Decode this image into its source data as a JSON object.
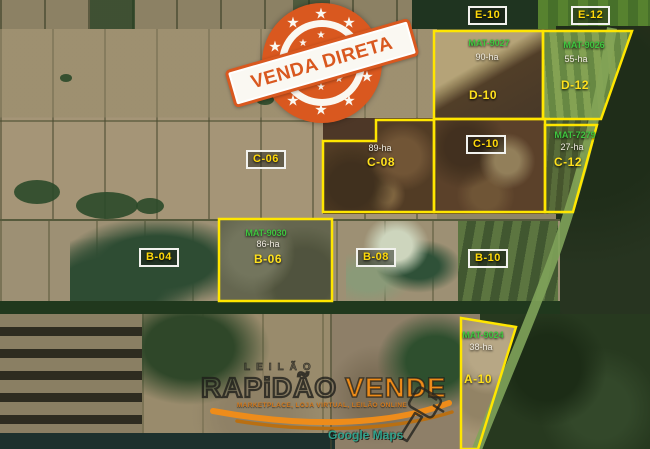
{
  "map": {
    "attribution": "Google Maps",
    "lots": {
      "boxed": [
        {
          "label": "E-10"
        },
        {
          "label": "E-12"
        },
        {
          "label": "C-06"
        },
        {
          "label": "C-10"
        },
        {
          "label": "B-04"
        },
        {
          "label": "B-08"
        },
        {
          "label": "B-10"
        }
      ],
      "parcels": [
        {
          "mat": "MAT-9027",
          "area": "90-ha",
          "name": "D-10"
        },
        {
          "mat": "MAT-9026",
          "area": "55-ha",
          "name": "D-12"
        },
        {
          "mat": "MAT-7279",
          "area": "27-ha",
          "name": "C-12"
        },
        {
          "mat": "",
          "area": "89-ha",
          "name": "C-08"
        },
        {
          "mat": "MAT-9030",
          "area": "86-ha",
          "name": "B-06"
        },
        {
          "mat": "MAT-9024",
          "area": "38-ha",
          "name": "A-10"
        }
      ]
    }
  },
  "stamp": {
    "text": "VENDA DIRETA"
  },
  "watermark": {
    "top_line": "LEILÃO",
    "brand_dark": "RAPiDÃO",
    "brand_orange": "VENDE",
    "subtitle": "MARKETPLACE, LOJA VIRTUAL, LEILÃO ONLINE"
  },
  "colors": {
    "parcel_outline": "#ffe600",
    "mat_green": "#3fc53f",
    "lot_label_yellow": "#ffd90a",
    "area_white": "#f2ede2",
    "stamp_orange": "#d9581f",
    "brand_orange": "#ee8c1a",
    "attribution_teal": "#2fa28c"
  }
}
